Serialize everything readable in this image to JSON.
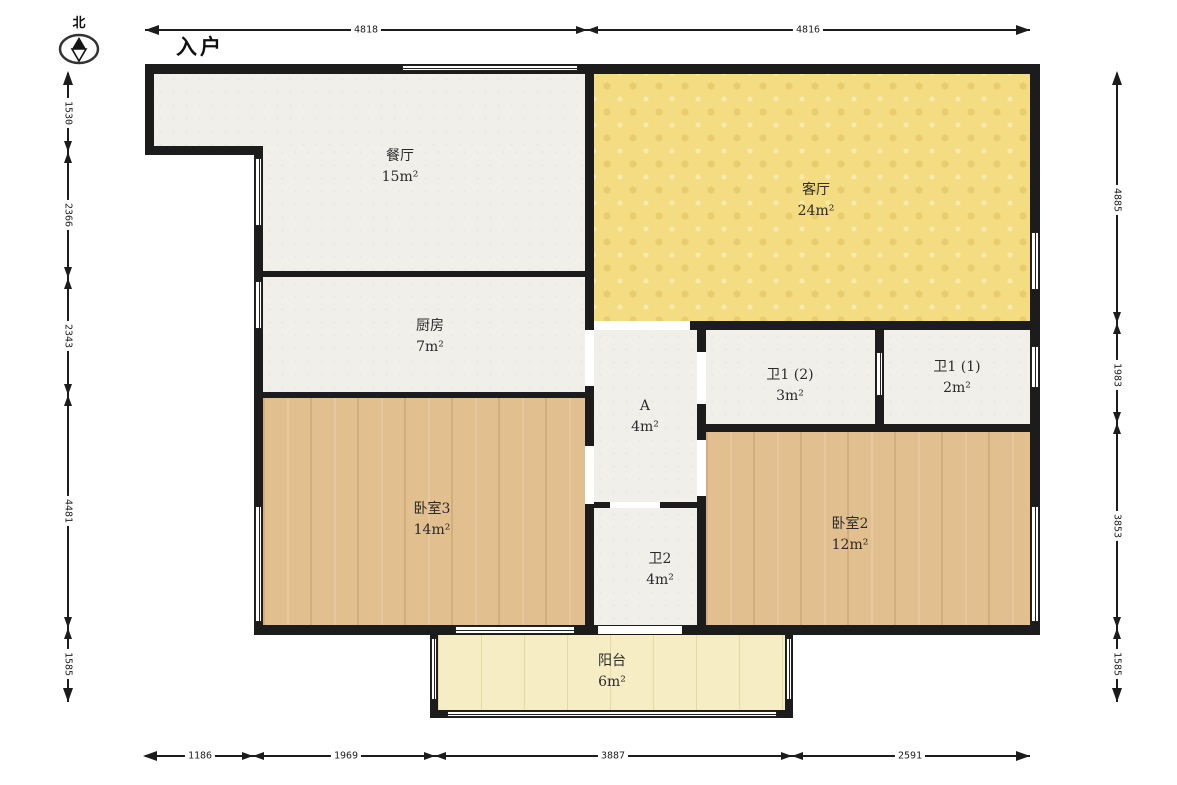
{
  "compass": {
    "north_label": "北"
  },
  "entrance": {
    "label": "入户"
  },
  "rooms": [
    {
      "id": "dining",
      "label": "餐厅",
      "area": "15m²"
    },
    {
      "id": "living",
      "label": "客厅",
      "area": "24m²"
    },
    {
      "id": "kitchen",
      "label": "厨房",
      "area": "7m²"
    },
    {
      "id": "bath1-2",
      "label": "卫1 (2)",
      "area": "3m²"
    },
    {
      "id": "bath1-1",
      "label": "卫1 (1)",
      "area": "2m²"
    },
    {
      "id": "hall-a",
      "label": "A",
      "area": "4m²"
    },
    {
      "id": "bedroom3",
      "label": "卧室3",
      "area": "14m²"
    },
    {
      "id": "bedroom2",
      "label": "卧室2",
      "area": "12m²"
    },
    {
      "id": "bath2",
      "label": "卫2",
      "area": "4m²"
    },
    {
      "id": "balcony",
      "label": "阳台",
      "area": "6m²"
    }
  ],
  "dims": {
    "top": [
      "4818",
      "4816"
    ],
    "bottom": [
      "1186",
      "1969",
      "3887",
      "2591"
    ],
    "left": [
      "1530",
      "2366",
      "2343",
      "4481",
      "1585"
    ],
    "right": [
      "4885",
      "1983",
      "3853",
      "1585"
    ]
  },
  "colors": {
    "wall": "#1c1c1c",
    "floor": "#f0efe9",
    "living": "#f3dc82",
    "wood": "#e2bf8e",
    "balcony": "#f7edc4"
  }
}
